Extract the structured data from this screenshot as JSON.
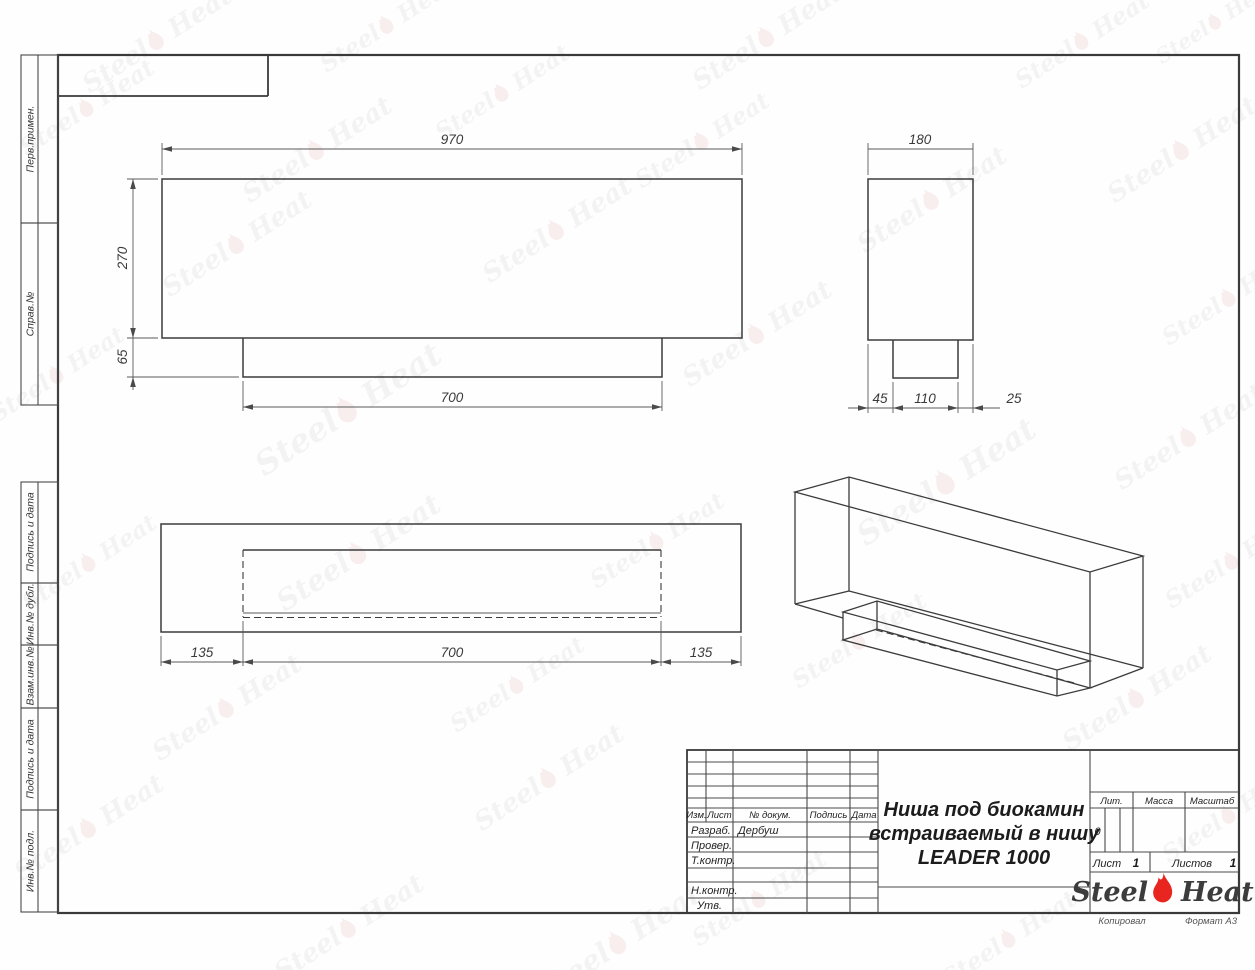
{
  "margin": [
    "Перв.примен.",
    "Справ.№",
    "Подпись и дата",
    "Инв.№ дубл.",
    "Взам.инв.№",
    "Подпись и дата",
    "Инв.№ подл."
  ],
  "dims": {
    "front": {
      "width": "970",
      "height": "270",
      "tab_height": "65",
      "tab_width": "700"
    },
    "side": {
      "width": "180",
      "seg_a": "45",
      "seg_b": "110",
      "seg_c": "25"
    },
    "plan": {
      "seg_a": "135",
      "seg_b": "700",
      "seg_c": "135"
    }
  },
  "tb": {
    "header": [
      "Изм.",
      "Лист",
      "№ докум.",
      "Подпись",
      "Дата"
    ],
    "rows": [
      {
        "label": "Разраб.",
        "value": "Дербуш"
      },
      {
        "label": "Провер.",
        "value": ""
      },
      {
        "label": "Т.контр.",
        "value": ""
      },
      {
        "label": "",
        "value": ""
      },
      {
        "label": "Н.контр.",
        "value": ""
      },
      {
        "label": "Утв.",
        "value": ""
      }
    ],
    "title": [
      "Ниша под биокамин",
      "встраиваемый в нишу",
      "LEADER 1000"
    ],
    "lit": "Лит.",
    "mass": "Масса",
    "scale": "Масштаб",
    "lit_val": "0",
    "sheet_label": "Лист",
    "sheet_num": "1",
    "sheets_label": "Листов",
    "sheets_num": "1"
  },
  "brand": {
    "left": "Steel",
    "right": "Heat"
  },
  "footer": {
    "copied": "Копировал",
    "format": "Формат А3"
  },
  "watermark": {
    "left": "Steel",
    "right": "Heat"
  },
  "colors": {
    "flame_red": "#e8251f",
    "line": "#3a3a3a"
  }
}
